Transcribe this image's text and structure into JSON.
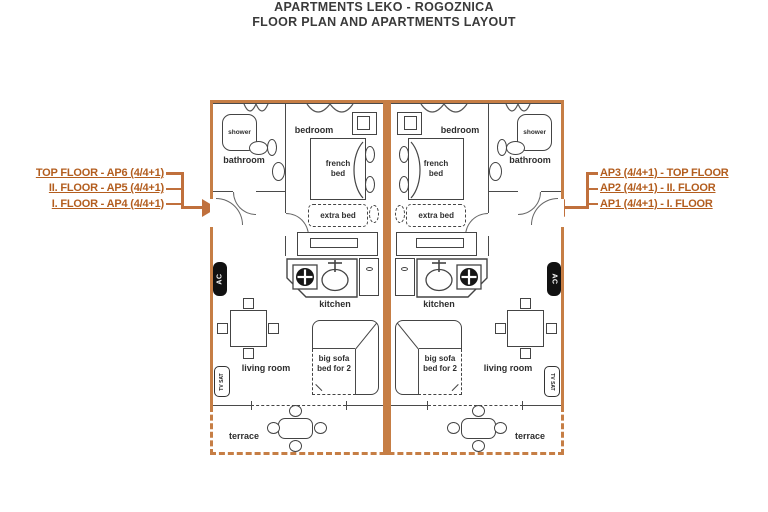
{
  "title": {
    "line1": "APARTMENTS LEKO - ROGOZNICA",
    "line2": "FLOOR PLAN AND APARTMENTS LAYOUT"
  },
  "legend_left": {
    "items": [
      "TOP FLOOR - AP6 (4/4+1)",
      "II. FLOOR - AP5 (4/4+1)",
      "I. FLOOR - AP4 (4/4+1)"
    ]
  },
  "legend_right": {
    "items": [
      "AP3 (4/4+1) - TOP FLOOR",
      "AP2 (4/4+1) - II. FLOOR",
      "AP1 (4/4+1) - I. FLOOR"
    ]
  },
  "plan": {
    "rooms": {
      "bedroom": "bedroom",
      "bathroom": "bathroom",
      "kitchen": "kitchen",
      "living_room": "living room",
      "terrace": "terrace"
    },
    "fixtures": {
      "shower": "shower",
      "ac": "AC",
      "tv_sat": "TV SAT"
    },
    "furniture": {
      "french_bed": "french bed",
      "extra_bed": "extra bed",
      "big_sofa_bed": "big sofa bed for 2"
    }
  },
  "colors": {
    "wall": "#c67e45",
    "legend_text": "#b35d1e",
    "line": "#444444",
    "title_text": "#3a3a3a"
  }
}
